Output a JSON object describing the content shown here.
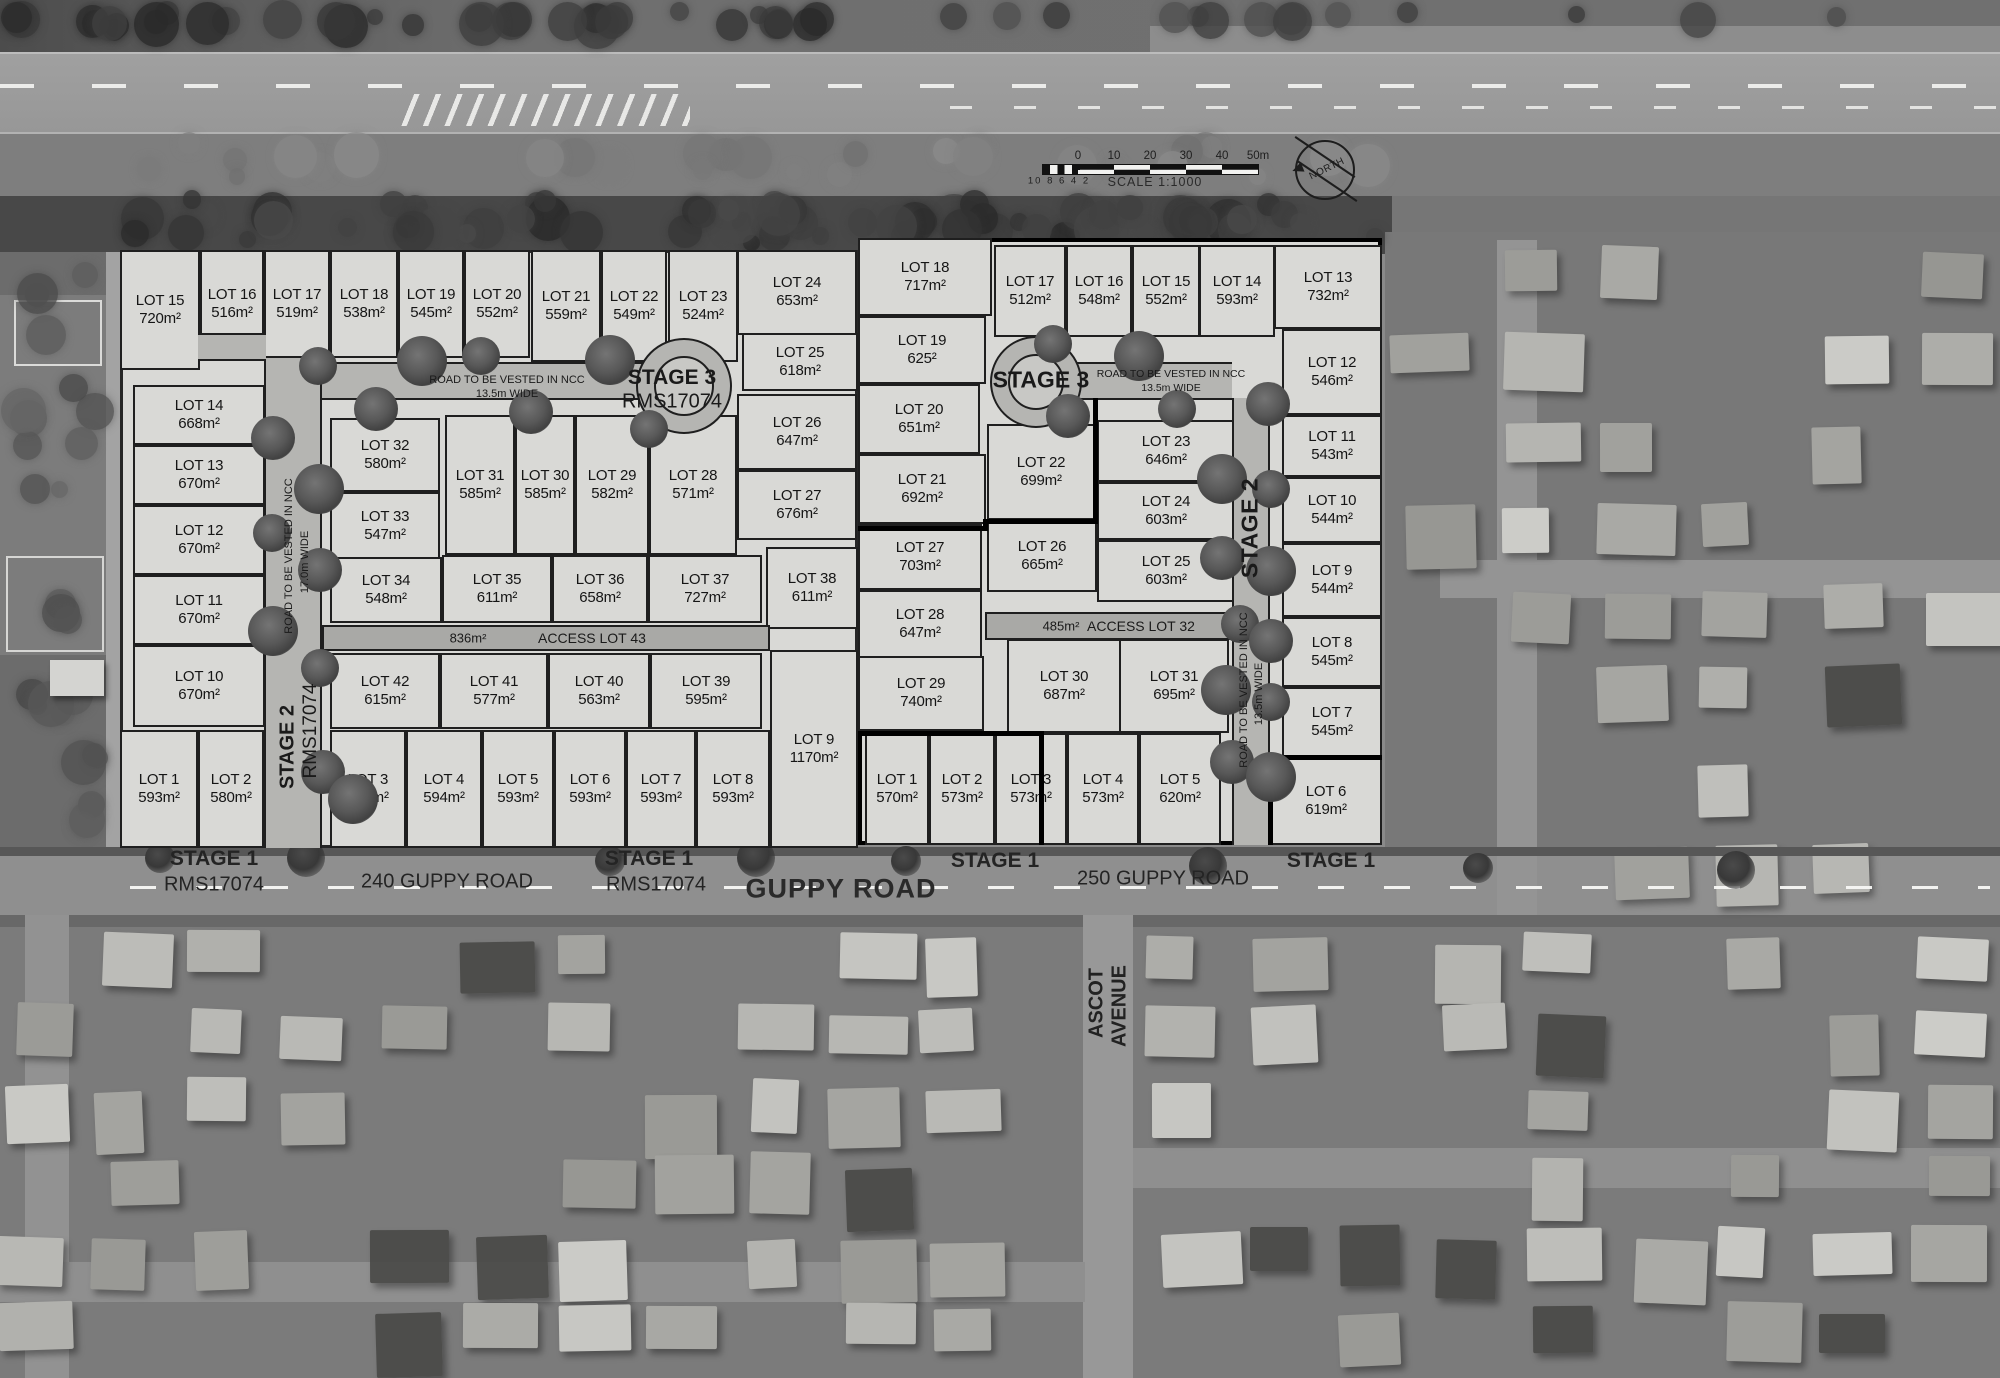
{
  "map_labels": {
    "guppy_road": "GUPPY ROAD",
    "address_240": "240 GUPPY ROAD",
    "address_250": "250 GUPPY ROAD",
    "ascot_line1": "ASCOT",
    "ascot_line2": "AVENUE"
  },
  "stage_banners": [
    {
      "stage": "STAGE 1",
      "ref": "RMS17074"
    },
    {
      "stage": "STAGE 1",
      "ref": "RMS17074"
    },
    {
      "stage": "STAGE 1",
      "ref": ""
    },
    {
      "stage": "STAGE 1",
      "ref": ""
    }
  ],
  "scale_bar": {
    "ticks": [
      "0",
      "10",
      "20",
      "30",
      "40",
      "50m"
    ],
    "minor": "10 8 6 4 2",
    "caption": "SCALE 1:1000"
  },
  "north_arrow": {
    "label": "NORTH"
  },
  "left_block": {
    "stage3_line1": "STAGE 3",
    "stage3_line2": "RMS17074",
    "stage2_vertical": "STAGE 2",
    "stage2_ref": "RMS17074",
    "road_h_line1": "ROAD TO BE VESTED IN NCC",
    "road_h_line2": "13.5m WIDE",
    "road_v_line1": "ROAD TO BE VESTED IN NCC",
    "road_v_line2": "17.0m WIDE",
    "access_area": "836m²",
    "access_label": "ACCESS LOT 43",
    "lots": [
      {
        "name": "LOT 1",
        "area": "593m²"
      },
      {
        "name": "LOT 2",
        "area": "580m²"
      },
      {
        "name": "LOT 3",
        "area": "535m²"
      },
      {
        "name": "LOT 4",
        "area": "594m²"
      },
      {
        "name": "LOT 5",
        "area": "593m²"
      },
      {
        "name": "LOT 6",
        "area": "593m²"
      },
      {
        "name": "LOT 7",
        "area": "593m²"
      },
      {
        "name": "LOT 8",
        "area": "593m²"
      },
      {
        "name": "LOT 9",
        "area": "1170m²"
      },
      {
        "name": "LOT 10",
        "area": "670m²"
      },
      {
        "name": "LOT 11",
        "area": "670m²"
      },
      {
        "name": "LOT 12",
        "area": "670m²"
      },
      {
        "name": "LOT 13",
        "area": "670m²"
      },
      {
        "name": "LOT 14",
        "area": "668m²"
      },
      {
        "name": "LOT 15",
        "area": "720m²"
      },
      {
        "name": "LOT 16",
        "area": "516m²"
      },
      {
        "name": "LOT 17",
        "area": "519m²"
      },
      {
        "name": "LOT 18",
        "area": "538m²"
      },
      {
        "name": "LOT 19",
        "area": "545m²"
      },
      {
        "name": "LOT 20",
        "area": "552m²"
      },
      {
        "name": "LOT 21",
        "area": "559m²"
      },
      {
        "name": "LOT 22",
        "area": "549m²"
      },
      {
        "name": "LOT 23",
        "area": "524m²"
      },
      {
        "name": "LOT 24",
        "area": "653m²"
      },
      {
        "name": "LOT 25",
        "area": "618m²"
      },
      {
        "name": "LOT 26",
        "area": "647m²"
      },
      {
        "name": "LOT 27",
        "area": "676m²"
      },
      {
        "name": "LOT 28",
        "area": "571m²"
      },
      {
        "name": "LOT 29",
        "area": "582m²"
      },
      {
        "name": "LOT 30",
        "area": "585m²"
      },
      {
        "name": "LOT 31",
        "area": "585m²"
      },
      {
        "name": "LOT 32",
        "area": "580m²"
      },
      {
        "name": "LOT 33",
        "area": "547m²"
      },
      {
        "name": "LOT 34",
        "area": "548m²"
      },
      {
        "name": "LOT 35",
        "area": "611m²"
      },
      {
        "name": "LOT 36",
        "area": "658m²"
      },
      {
        "name": "LOT 37",
        "area": "727m²"
      },
      {
        "name": "LOT 38",
        "area": "611m²"
      },
      {
        "name": "LOT 39",
        "area": "595m²"
      },
      {
        "name": "LOT 40",
        "area": "563m²"
      },
      {
        "name": "LOT 41",
        "area": "577m²"
      },
      {
        "name": "LOT 42",
        "area": "615m²"
      }
    ]
  },
  "right_block": {
    "stage3": "STAGE 3",
    "stage2_vertical": "STAGE 2",
    "road_h_line1": "ROAD TO BE VESTED IN NCC",
    "road_h_line2": "13.5m WIDE",
    "road_v_line1": "ROAD TO BE VESTED IN NCC",
    "road_v_line2": "13.5m WIDE",
    "access_area": "485m²",
    "access_label": "ACCESS LOT 32",
    "lots": [
      {
        "name": "LOT 1",
        "area": "570m²"
      },
      {
        "name": "LOT 2",
        "area": "573m²"
      },
      {
        "name": "LOT 3",
        "area": "573m²"
      },
      {
        "name": "LOT 4",
        "area": "573m²"
      },
      {
        "name": "LOT 5",
        "area": "620m²"
      },
      {
        "name": "LOT 6",
        "area": "619m²"
      },
      {
        "name": "LOT 7",
        "area": "545m²"
      },
      {
        "name": "LOT 8",
        "area": "545m²"
      },
      {
        "name": "LOT 9",
        "area": "544m²"
      },
      {
        "name": "LOT 10",
        "area": "544m²"
      },
      {
        "name": "LOT 11",
        "area": "543m²"
      },
      {
        "name": "LOT 12",
        "area": "546m²"
      },
      {
        "name": "LOT 13",
        "area": "732m²"
      },
      {
        "name": "LOT 14",
        "area": "593m²"
      },
      {
        "name": "LOT 15",
        "area": "552m²"
      },
      {
        "name": "LOT 16",
        "area": "548m²"
      },
      {
        "name": "LOT 17",
        "area": "512m²"
      },
      {
        "name": "LOT 18",
        "area": "717m²"
      },
      {
        "name": "LOT 19",
        "area": "625²"
      },
      {
        "name": "LOT 20",
        "area": "651m²"
      },
      {
        "name": "LOT 21",
        "area": "692m²"
      },
      {
        "name": "LOT 22",
        "area": "699m²"
      },
      {
        "name": "LOT 23",
        "area": "646m²"
      },
      {
        "name": "LOT 24",
        "area": "603m²"
      },
      {
        "name": "LOT 25",
        "area": "603m²"
      },
      {
        "name": "LOT 26",
        "area": "665m²"
      },
      {
        "name": "LOT 27",
        "area": "703m²"
      },
      {
        "name": "LOT 28",
        "area": "647m²"
      },
      {
        "name": "LOT 29",
        "area": "740m²"
      },
      {
        "name": "LOT 30",
        "area": "687m²"
      },
      {
        "name": "LOT 31",
        "area": "695m²"
      }
    ]
  }
}
